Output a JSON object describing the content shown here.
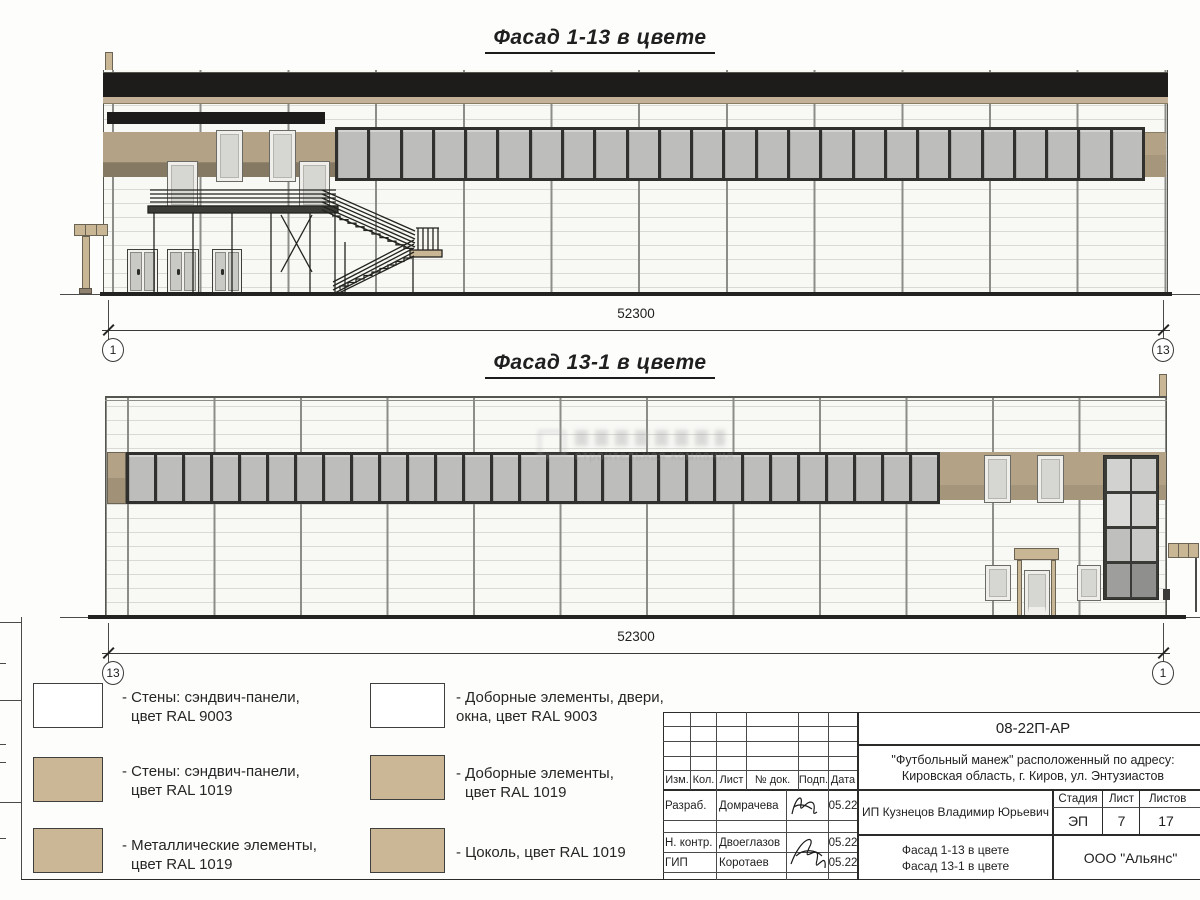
{
  "drawing": {
    "facade_top": {
      "title": "Фасад 1-13 в цвете",
      "dimension": "52300",
      "axis_left": "1",
      "axis_right": "13"
    },
    "facade_bottom": {
      "title": "Фасад 13-1 в цвете",
      "dimension": "52300",
      "axis_left": "13",
      "axis_right": "1"
    }
  },
  "watermark": {
    "subtitle": "строительная компания"
  },
  "legend": {
    "items": [
      {
        "label_line1": "- Стены: сэндвич-панели,",
        "label_line2": "цвет RAL 9003",
        "color": "#ffffff"
      },
      {
        "label_line1": "- Стены: сэндвич-панели,",
        "label_line2": "цвет RAL 1019",
        "color": "#cbb695"
      },
      {
        "label_line1": "- Металлические элементы,",
        "label_line2": "цвет RAL 1019",
        "color": "#cbb695"
      },
      {
        "label_line1": "- Доборные элементы, двери,",
        "label_line2": "окна, цвет RAL 9003",
        "color": "#ffffff"
      },
      {
        "label_line1": "- Доборные элементы,",
        "label_line2": "цвет RAL 1019",
        "color": "#cbb695"
      },
      {
        "label_line1": "- Цоколь, цвет RAL 1019",
        "label_line2": "",
        "color": "#cbb695"
      }
    ]
  },
  "title_block": {
    "doc_number": "08-22П-АР",
    "project_line1": "\"Футбольный манеж\" расположенный по адресу:",
    "project_line2": "Кировская область, г. Киров, ул. Энтузиастов",
    "header_cols": {
      "izm": "Изм.",
      "kol": "Кол.",
      "list": "Лист",
      "doc": "№ док.",
      "podp": "Подп.",
      "data": "Дата"
    },
    "rows": [
      {
        "role": "Разраб.",
        "name": "Домрачева",
        "date": "05.22"
      },
      {
        "role": "Н. контр.",
        "name": "Двоеглазов",
        "date": "05.22"
      },
      {
        "role": "ГИП",
        "name": "Коротаев",
        "date": "05.22"
      }
    ],
    "client": "ИП Кузнецов Владимир Юрьевич",
    "stage_label": "Стадия",
    "stage_value": "ЭП",
    "sheet_label": "Лист",
    "sheet_value": "7",
    "sheets_label": "Листов",
    "sheets_value": "17",
    "sheet_title_line1": "Фасад 1-13 в цвете",
    "sheet_title_line2": "Фасад 13-1 в цвете",
    "company": "ООО \"Альянс\""
  },
  "colors": {
    "ral1019_band": "#b3a285",
    "ral1019_legend": "#cbb695",
    "ral9003": "#ffffff",
    "roof_black": "#1d1c1a",
    "glass": "#bdbdbb",
    "frame_dark": "#30302e"
  }
}
